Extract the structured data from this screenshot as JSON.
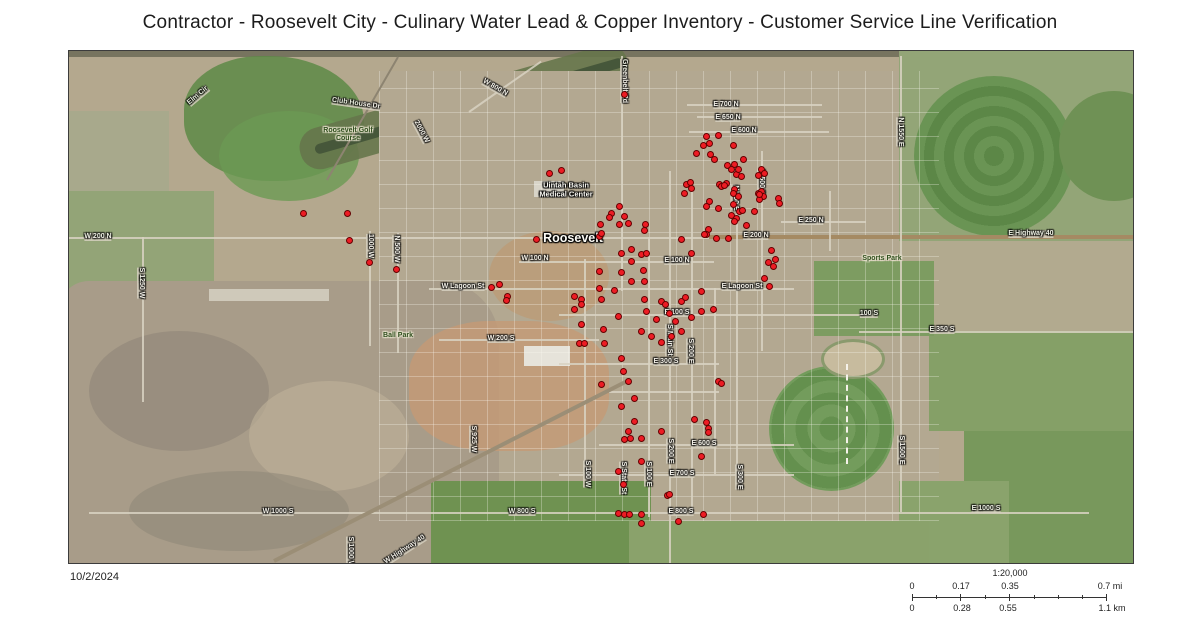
{
  "title": "Contractor - Roosevelt City - Culinary Water Lead & Copper Inventory - Customer Service Line Verification",
  "date": "10/2/2024",
  "scale": {
    "ratio": "1:20,000",
    "mi": {
      "labels": [
        "0",
        "0.17",
        "0.35",
        "0.7 mi"
      ]
    },
    "km": {
      "labels": [
        "0",
        "0.28",
        "0.55",
        "1.1 km"
      ]
    }
  },
  "map": {
    "point_color": "#ed1c24",
    "point_outline": "#640000",
    "labels": [
      {
        "t": "Elm Cir",
        "x": 197,
        "y": 95,
        "r": -40,
        "c": "road"
      },
      {
        "t": "Club House Dr",
        "x": 355,
        "y": 103,
        "r": 8,
        "c": "road"
      },
      {
        "t": "2000 W",
        "x": 420,
        "y": 131,
        "r": 62,
        "c": "road"
      },
      {
        "t": "W 800 N",
        "x": 494,
        "y": 87,
        "r": 30,
        "c": "road"
      },
      {
        "t": "Greenbelt Rd",
        "x": 623,
        "y": 80,
        "r": 90,
        "c": "road"
      },
      {
        "t": "E 700 N",
        "x": 725,
        "y": 104,
        "r": 0,
        "c": "road"
      },
      {
        "t": "E 650 N",
        "x": 727,
        "y": 117,
        "r": 0,
        "c": "road"
      },
      {
        "t": "E 600 N",
        "x": 743,
        "y": 130,
        "r": 0,
        "c": "road"
      },
      {
        "t": "N 1550 E",
        "x": 899,
        "y": 131,
        "r": 90,
        "c": "road"
      },
      {
        "t": "Uintah Basin\nMedical Center",
        "x": 565,
        "y": 189,
        "r": 0,
        "c": "poi"
      },
      {
        "t": "Roosevelt Golf\nCourse",
        "x": 347,
        "y": 134,
        "r": 0,
        "c": "park"
      },
      {
        "t": "Roosevelt",
        "x": 572,
        "y": 237,
        "r": 0,
        "c": "city"
      },
      {
        "t": "W 200 N",
        "x": 97,
        "y": 236,
        "r": 0,
        "c": "road"
      },
      {
        "t": "E 200 N",
        "x": 755,
        "y": 235,
        "r": 0,
        "c": "road"
      },
      {
        "t": "E 250 N",
        "x": 810,
        "y": 220,
        "r": 0,
        "c": "road"
      },
      {
        "t": "E Highway 40",
        "x": 1030,
        "y": 233,
        "r": 0,
        "c": "road"
      },
      {
        "t": "Sports Park",
        "x": 881,
        "y": 258,
        "r": 0,
        "c": "park"
      },
      {
        "t": "N 500 E",
        "x": 760,
        "y": 181,
        "r": 90,
        "c": "road"
      },
      {
        "t": "N 200 E",
        "x": 734,
        "y": 197,
        "r": 90,
        "c": "road"
      },
      {
        "t": "S 1250 W",
        "x": 140,
        "y": 282,
        "r": 90,
        "c": "road"
      },
      {
        "t": "1000 W",
        "x": 369,
        "y": 245,
        "r": 90,
        "c": "road"
      },
      {
        "t": "N 500 W",
        "x": 395,
        "y": 248,
        "r": 90,
        "c": "road"
      },
      {
        "t": "W 100 N",
        "x": 534,
        "y": 258,
        "r": 0,
        "c": "road"
      },
      {
        "t": "E 100 N",
        "x": 676,
        "y": 260,
        "r": 0,
        "c": "road"
      },
      {
        "t": "W Lagoon St",
        "x": 462,
        "y": 286,
        "r": 0,
        "c": "road"
      },
      {
        "t": "E Lagoon St",
        "x": 741,
        "y": 286,
        "r": 0,
        "c": "road"
      },
      {
        "t": "Ball Park",
        "x": 397,
        "y": 335,
        "r": 0,
        "c": "park"
      },
      {
        "t": "W 200 S",
        "x": 500,
        "y": 338,
        "r": 0,
        "c": "road"
      },
      {
        "t": "E 100 S",
        "x": 676,
        "y": 312,
        "r": 0,
        "c": "road"
      },
      {
        "t": "E 300 S",
        "x": 665,
        "y": 361,
        "r": 0,
        "c": "road"
      },
      {
        "t": "S Main St",
        "x": 668,
        "y": 339,
        "r": 90,
        "c": "road"
      },
      {
        "t": "S 200 E",
        "x": 689,
        "y": 350,
        "r": 90,
        "c": "road"
      },
      {
        "t": "100 S",
        "x": 868,
        "y": 313,
        "r": 0,
        "c": "road"
      },
      {
        "t": "E 350 S",
        "x": 941,
        "y": 329,
        "r": 0,
        "c": "road"
      },
      {
        "t": "S 925 W",
        "x": 472,
        "y": 438,
        "r": 90,
        "c": "road"
      },
      {
        "t": "E 600 S",
        "x": 703,
        "y": 443,
        "r": 0,
        "c": "road"
      },
      {
        "t": "E 700 S",
        "x": 681,
        "y": 473,
        "r": 0,
        "c": "road"
      },
      {
        "t": "S 100 W",
        "x": 586,
        "y": 473,
        "r": 90,
        "c": "road"
      },
      {
        "t": "S State St",
        "x": 622,
        "y": 477,
        "r": 90,
        "c": "road"
      },
      {
        "t": "S 100 E",
        "x": 647,
        "y": 473,
        "r": 90,
        "c": "road"
      },
      {
        "t": "S 200 E",
        "x": 669,
        "y": 450,
        "r": 90,
        "c": "road"
      },
      {
        "t": "S 300 E",
        "x": 738,
        "y": 476,
        "r": 90,
        "c": "road"
      },
      {
        "t": "E 800 S",
        "x": 680,
        "y": 511,
        "r": 0,
        "c": "road"
      },
      {
        "t": "W 800 S",
        "x": 521,
        "y": 511,
        "r": 0,
        "c": "road"
      },
      {
        "t": "W 1000 S",
        "x": 277,
        "y": 511,
        "r": 0,
        "c": "road"
      },
      {
        "t": "E 1000 S",
        "x": 985,
        "y": 508,
        "r": 0,
        "c": "road"
      },
      {
        "t": "S 1500 E",
        "x": 900,
        "y": 449,
        "r": 90,
        "c": "road"
      },
      {
        "t": "W Highway 40",
        "x": 404,
        "y": 549,
        "r": -33,
        "c": "road"
      },
      {
        "t": "S 1000 W",
        "x": 349,
        "y": 551,
        "r": 90,
        "c": "road"
      }
    ],
    "points": [
      [
        705,
        135
      ],
      [
        717,
        134
      ],
      [
        702,
        144
      ],
      [
        708,
        142
      ],
      [
        695,
        152
      ],
      [
        709,
        153
      ],
      [
        713,
        158
      ],
      [
        732,
        144
      ],
      [
        742,
        158
      ],
      [
        733,
        163
      ],
      [
        726,
        164
      ],
      [
        730,
        168
      ],
      [
        735,
        173
      ],
      [
        737,
        168
      ],
      [
        760,
        168
      ],
      [
        757,
        174
      ],
      [
        763,
        172
      ],
      [
        685,
        183
      ],
      [
        689,
        181
      ],
      [
        690,
        187
      ],
      [
        683,
        192
      ],
      [
        718,
        183
      ],
      [
        725,
        182
      ],
      [
        733,
        188
      ],
      [
        732,
        192
      ],
      [
        757,
        192
      ],
      [
        760,
        190
      ],
      [
        762,
        195
      ],
      [
        758,
        198
      ],
      [
        777,
        197
      ],
      [
        778,
        202
      ],
      [
        708,
        200
      ],
      [
        705,
        205
      ],
      [
        738,
        210
      ],
      [
        741,
        209
      ],
      [
        730,
        214
      ],
      [
        735,
        217
      ],
      [
        733,
        220
      ],
      [
        707,
        228
      ],
      [
        705,
        233
      ],
      [
        715,
        237
      ],
      [
        727,
        237
      ],
      [
        680,
        238
      ],
      [
        745,
        224
      ],
      [
        753,
        210
      ],
      [
        758,
        193
      ],
      [
        740,
        175
      ],
      [
        737,
        195
      ],
      [
        720,
        185
      ],
      [
        723,
        184
      ],
      [
        732,
        203
      ],
      [
        717,
        207
      ],
      [
        623,
        93
      ],
      [
        302,
        212
      ],
      [
        346,
        212
      ],
      [
        348,
        239
      ],
      [
        368,
        261
      ],
      [
        395,
        268
      ],
      [
        548,
        172
      ],
      [
        560,
        169
      ],
      [
        535,
        238
      ],
      [
        598,
        235
      ],
      [
        610,
        212
      ],
      [
        608,
        216
      ],
      [
        618,
        205
      ],
      [
        623,
        215
      ],
      [
        618,
        223
      ],
      [
        627,
        222
      ],
      [
        599,
        223
      ],
      [
        600,
        232
      ],
      [
        644,
        223
      ],
      [
        643,
        229
      ],
      [
        630,
        248
      ],
      [
        620,
        252
      ],
      [
        630,
        260
      ],
      [
        640,
        253
      ],
      [
        645,
        252
      ],
      [
        690,
        252
      ],
      [
        703,
        233
      ],
      [
        598,
        270
      ],
      [
        620,
        271
      ],
      [
        642,
        269
      ],
      [
        630,
        280
      ],
      [
        643,
        280
      ],
      [
        767,
        261
      ],
      [
        772,
        265
      ],
      [
        770,
        249
      ],
      [
        774,
        258
      ],
      [
        763,
        277
      ],
      [
        768,
        285
      ],
      [
        490,
        286
      ],
      [
        498,
        283
      ],
      [
        506,
        295
      ],
      [
        505,
        299
      ],
      [
        573,
        295
      ],
      [
        580,
        298
      ],
      [
        573,
        308
      ],
      [
        580,
        303
      ],
      [
        600,
        298
      ],
      [
        598,
        287
      ],
      [
        613,
        289
      ],
      [
        617,
        315
      ],
      [
        602,
        328
      ],
      [
        580,
        323
      ],
      [
        578,
        342
      ],
      [
        583,
        342
      ],
      [
        603,
        342
      ],
      [
        620,
        357
      ],
      [
        622,
        370
      ],
      [
        627,
        380
      ],
      [
        643,
        298
      ],
      [
        645,
        310
      ],
      [
        660,
        300
      ],
      [
        664,
        303
      ],
      [
        680,
        300
      ],
      [
        684,
        296
      ],
      [
        700,
        290
      ],
      [
        640,
        330
      ],
      [
        650,
        335
      ],
      [
        660,
        341
      ],
      [
        670,
        335
      ],
      [
        680,
        330
      ],
      [
        655,
        318
      ],
      [
        668,
        312
      ],
      [
        674,
        320
      ],
      [
        690,
        316
      ],
      [
        700,
        310
      ],
      [
        712,
        308
      ],
      [
        600,
        383
      ],
      [
        633,
        397
      ],
      [
        620,
        405
      ],
      [
        633,
        420
      ],
      [
        627,
        430
      ],
      [
        640,
        437
      ],
      [
        623,
        438
      ],
      [
        629,
        437
      ],
      [
        617,
        470
      ],
      [
        640,
        460
      ],
      [
        660,
        430
      ],
      [
        700,
        455
      ],
      [
        666,
        494
      ],
      [
        668,
        493
      ],
      [
        617,
        512
      ],
      [
        622,
        483
      ],
      [
        623,
        513
      ],
      [
        628,
        513
      ],
      [
        640,
        513
      ],
      [
        640,
        522
      ],
      [
        677,
        520
      ],
      [
        693,
        418
      ],
      [
        705,
        421
      ],
      [
        707,
        427
      ],
      [
        707,
        431
      ],
      [
        702,
        513
      ],
      [
        717,
        380
      ],
      [
        720,
        382
      ]
    ]
  }
}
